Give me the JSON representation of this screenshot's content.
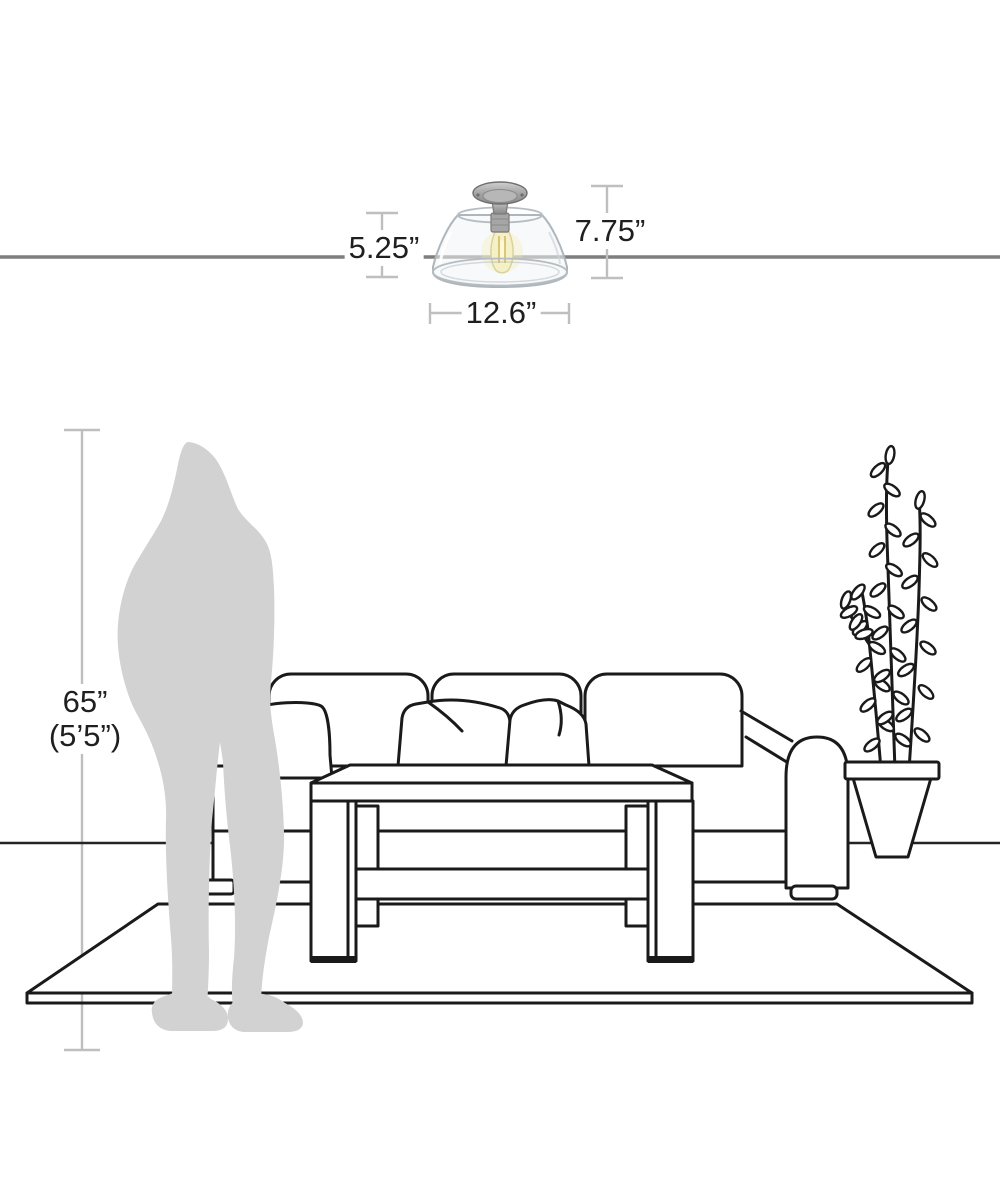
{
  "page": {
    "title": "Semi-flush ceiling light dimensions diagram"
  },
  "labels": {
    "fixture_glass_height": "5.25”",
    "fixture_total_height": "7.75”",
    "fixture_width": "12.6”",
    "person_height_inches": "65”",
    "person_height_feet": "(5’5”)"
  },
  "colors": {
    "line_art": "#1a1a1a",
    "ceiling_line": "#7e7e7e",
    "measure_line": "#bfbfbf",
    "silhouette": "#d2d2d2",
    "metal": "#9b9b9b",
    "bulb_glow": "#f3e9a9",
    "background": "#ffffff"
  },
  "scene": {
    "items": [
      "ceiling-line",
      "ceiling-light-fixture",
      "glass-dome-shade",
      "edison-bulb",
      "person-silhouette",
      "sofa",
      "throw-pillows",
      "coffee-table",
      "potted-plant",
      "area-rug",
      "floor-line"
    ]
  }
}
